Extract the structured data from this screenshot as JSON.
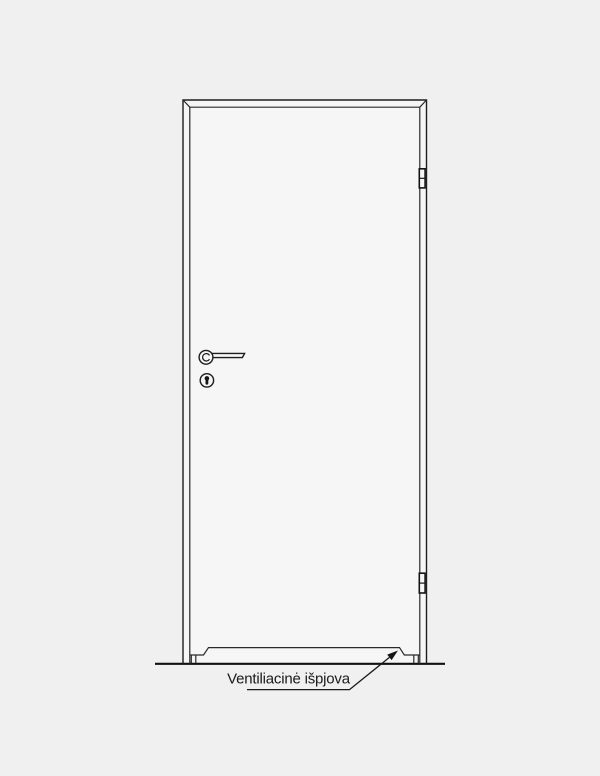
{
  "diagram": {
    "type": "door-elevation-technical-drawing",
    "annotation": {
      "text": "Ventiliacinė išpjova"
    },
    "colors": {
      "background": "#f0f0f0",
      "door_fill": "#f6f6f6",
      "line": "#1e1e1e",
      "arrow": "#161616"
    }
  }
}
